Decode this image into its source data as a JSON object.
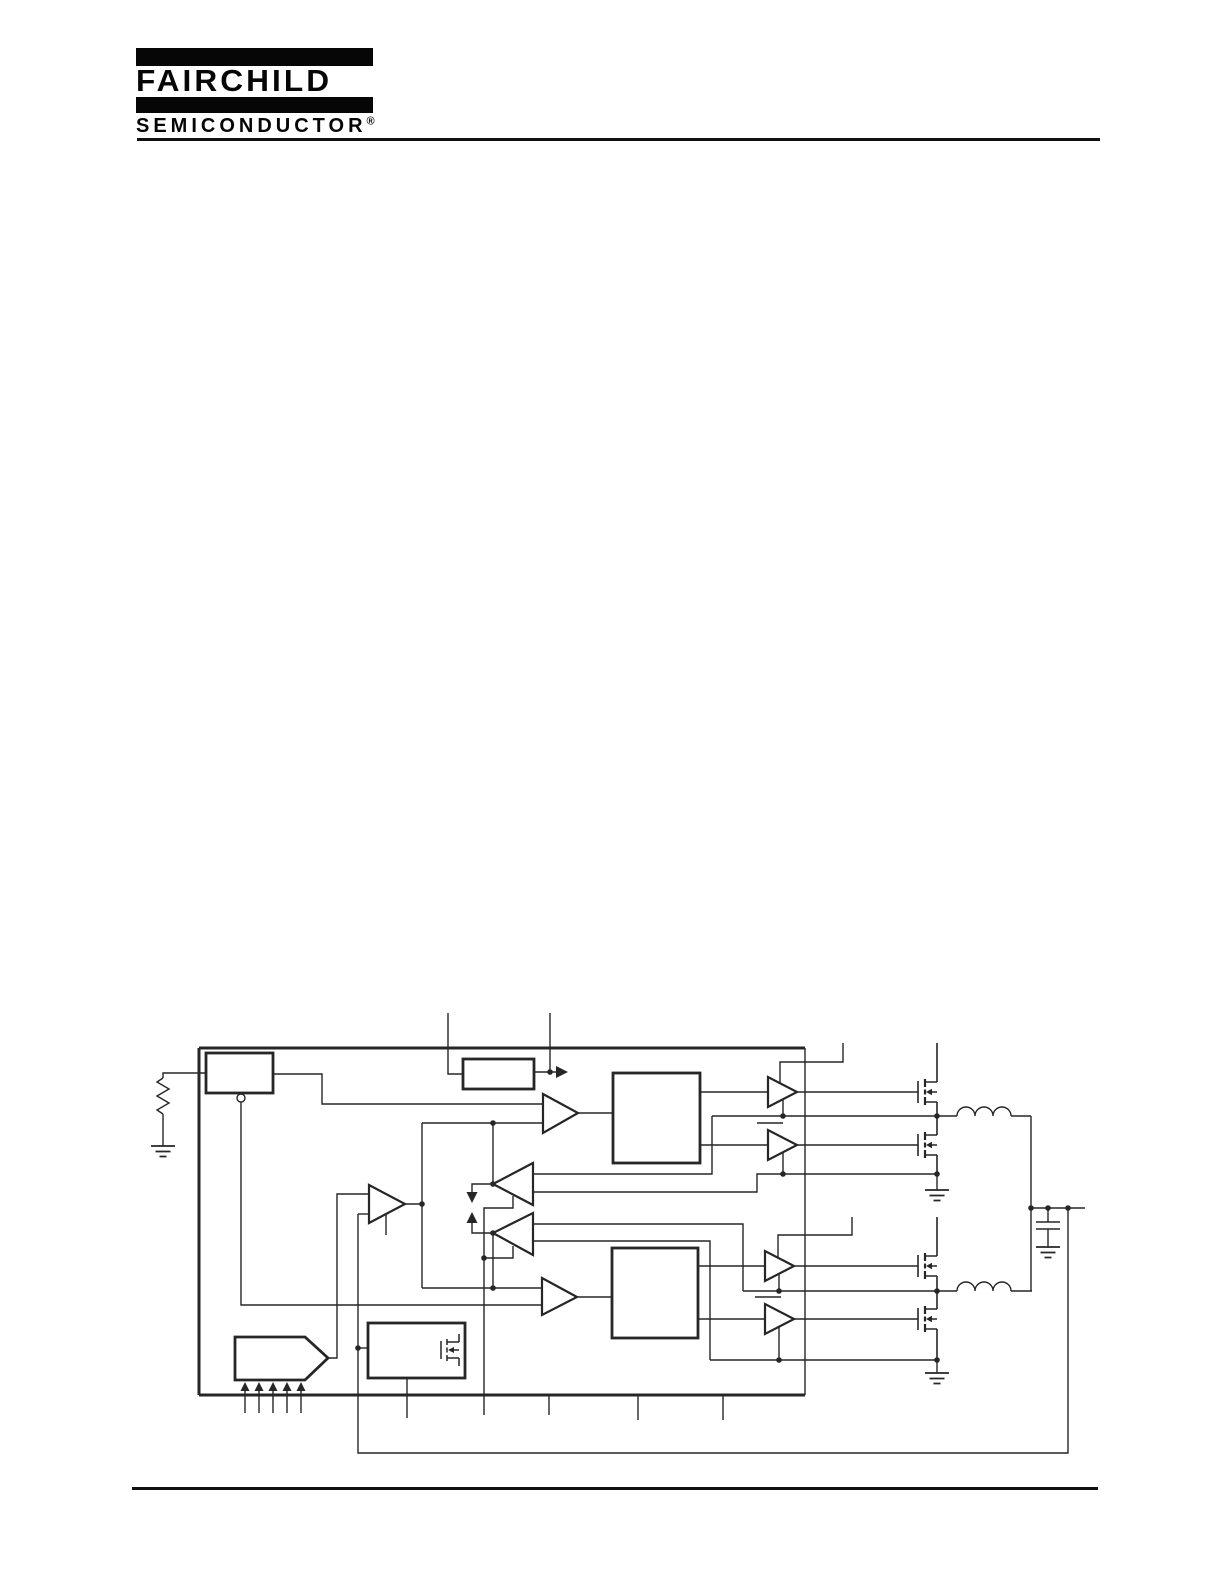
{
  "page": {
    "kind": "semiconductor datasheet page",
    "paper_color": "#ffffff",
    "ink_color": "#262626"
  },
  "header": {
    "brand": "FAIRCHILD",
    "subbrand": "SEMICONDUCTOR",
    "registered_mark": "®"
  },
  "diagram": {
    "title": "",
    "type": "block-diagram",
    "ic_boundary": true,
    "components": [
      "frequency-set-resistor",
      "oscillator-block",
      "reference-current-block",
      "pwm-comparator-1",
      "pwm-comparator-2",
      "control-logic-block-1",
      "control-logic-block-2",
      "error-amplifier",
      "current-sense-amplifier-1",
      "current-sense-amplifier-2",
      "vid-dac-pentagon",
      "soft-start-block",
      "gate-driver-high-1",
      "gate-driver-low-1",
      "gate-driver-high-2",
      "gate-driver-low-2",
      "high-side-mosfet-1",
      "low-side-mosfet-1",
      "high-side-mosfet-2",
      "low-side-mosfet-2",
      "inductor-1",
      "inductor-2",
      "output-capacitor",
      "feedback-loop"
    ],
    "pin_counts": {
      "top_pins": 2,
      "bottom_pins": 5,
      "vid_input_arrows": 5
    },
    "ground_symbols": 4,
    "junction_dots": 19
  }
}
